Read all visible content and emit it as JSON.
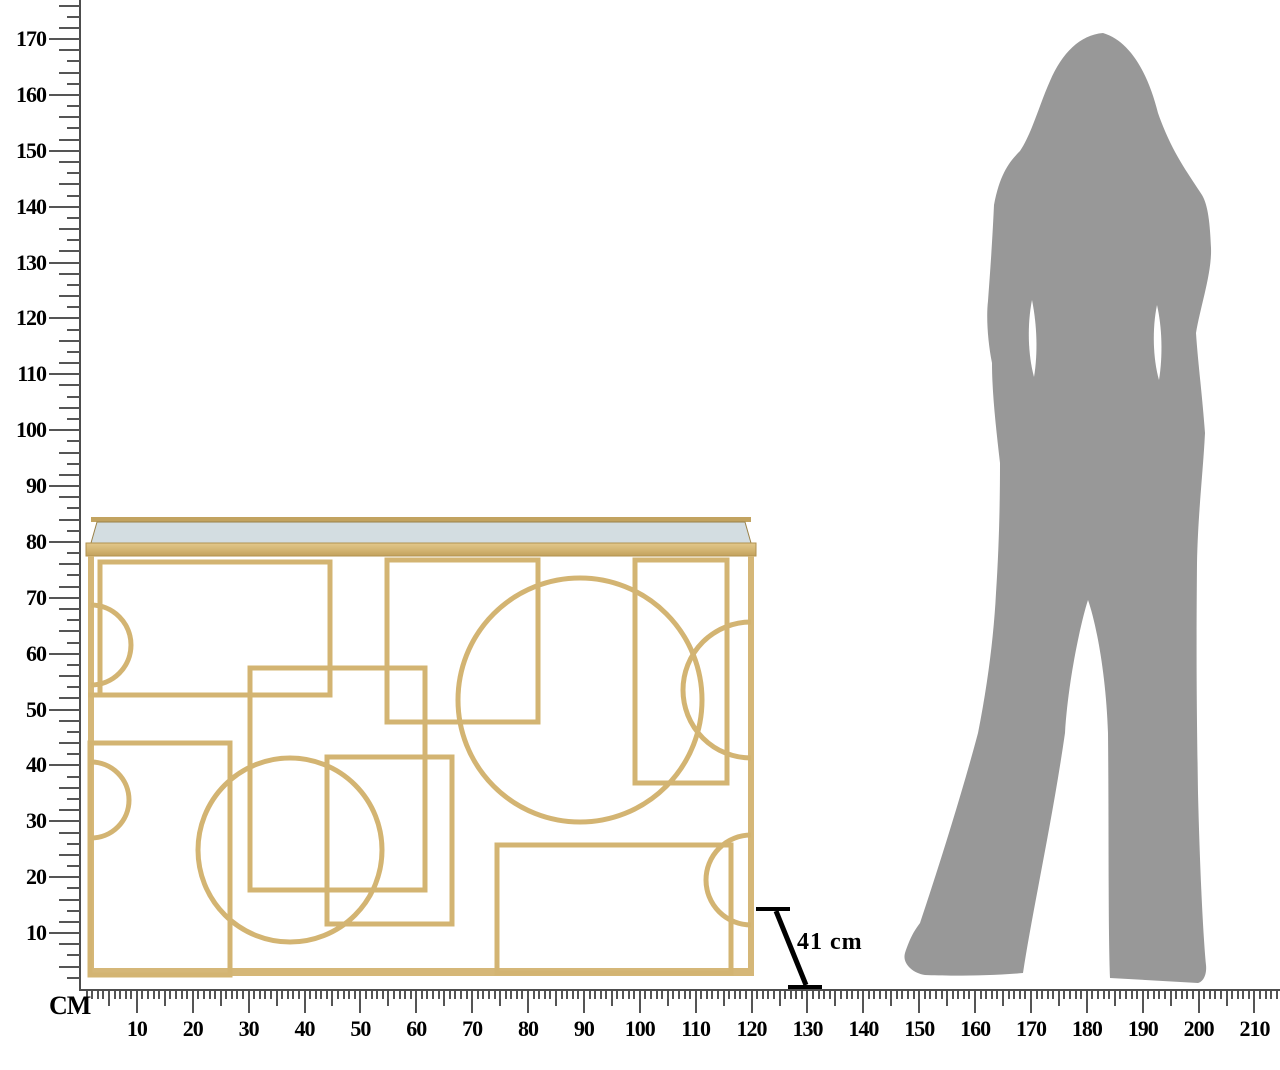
{
  "page": {
    "background": "#ffffff"
  },
  "rulers": {
    "unit_label": "CM",
    "vertical": {
      "tick_labels": [
        10,
        20,
        30,
        40,
        50,
        60,
        70,
        80,
        90,
        100,
        110,
        120,
        130,
        140,
        150,
        160,
        170
      ],
      "minor_step_cm": 2,
      "labeled_step_cm": 10,
      "max_cm": 176
    },
    "horizontal": {
      "tick_labels": [
        10,
        20,
        30,
        40,
        50,
        60,
        70,
        80,
        90,
        100,
        110,
        120,
        130,
        140,
        150,
        160,
        170,
        180,
        190,
        200,
        210
      ],
      "minor_step_cm": 1,
      "labeled_step_cm": 10,
      "max_cm": 214
    }
  },
  "dimension_annotation": {
    "label": "41 cm"
  },
  "illustration": {
    "table": {
      "name": "gold-geometric-console-table",
      "frame_color": "#d3b472",
      "solid_color": "#d5b778",
      "mirror_color": "#d3dde1",
      "edge_color": "#b2924f"
    },
    "person": {
      "name": "standing-woman-silhouette",
      "color": "#989898"
    }
  },
  "colors": {
    "tick": "#555555",
    "label": "#000000"
  }
}
